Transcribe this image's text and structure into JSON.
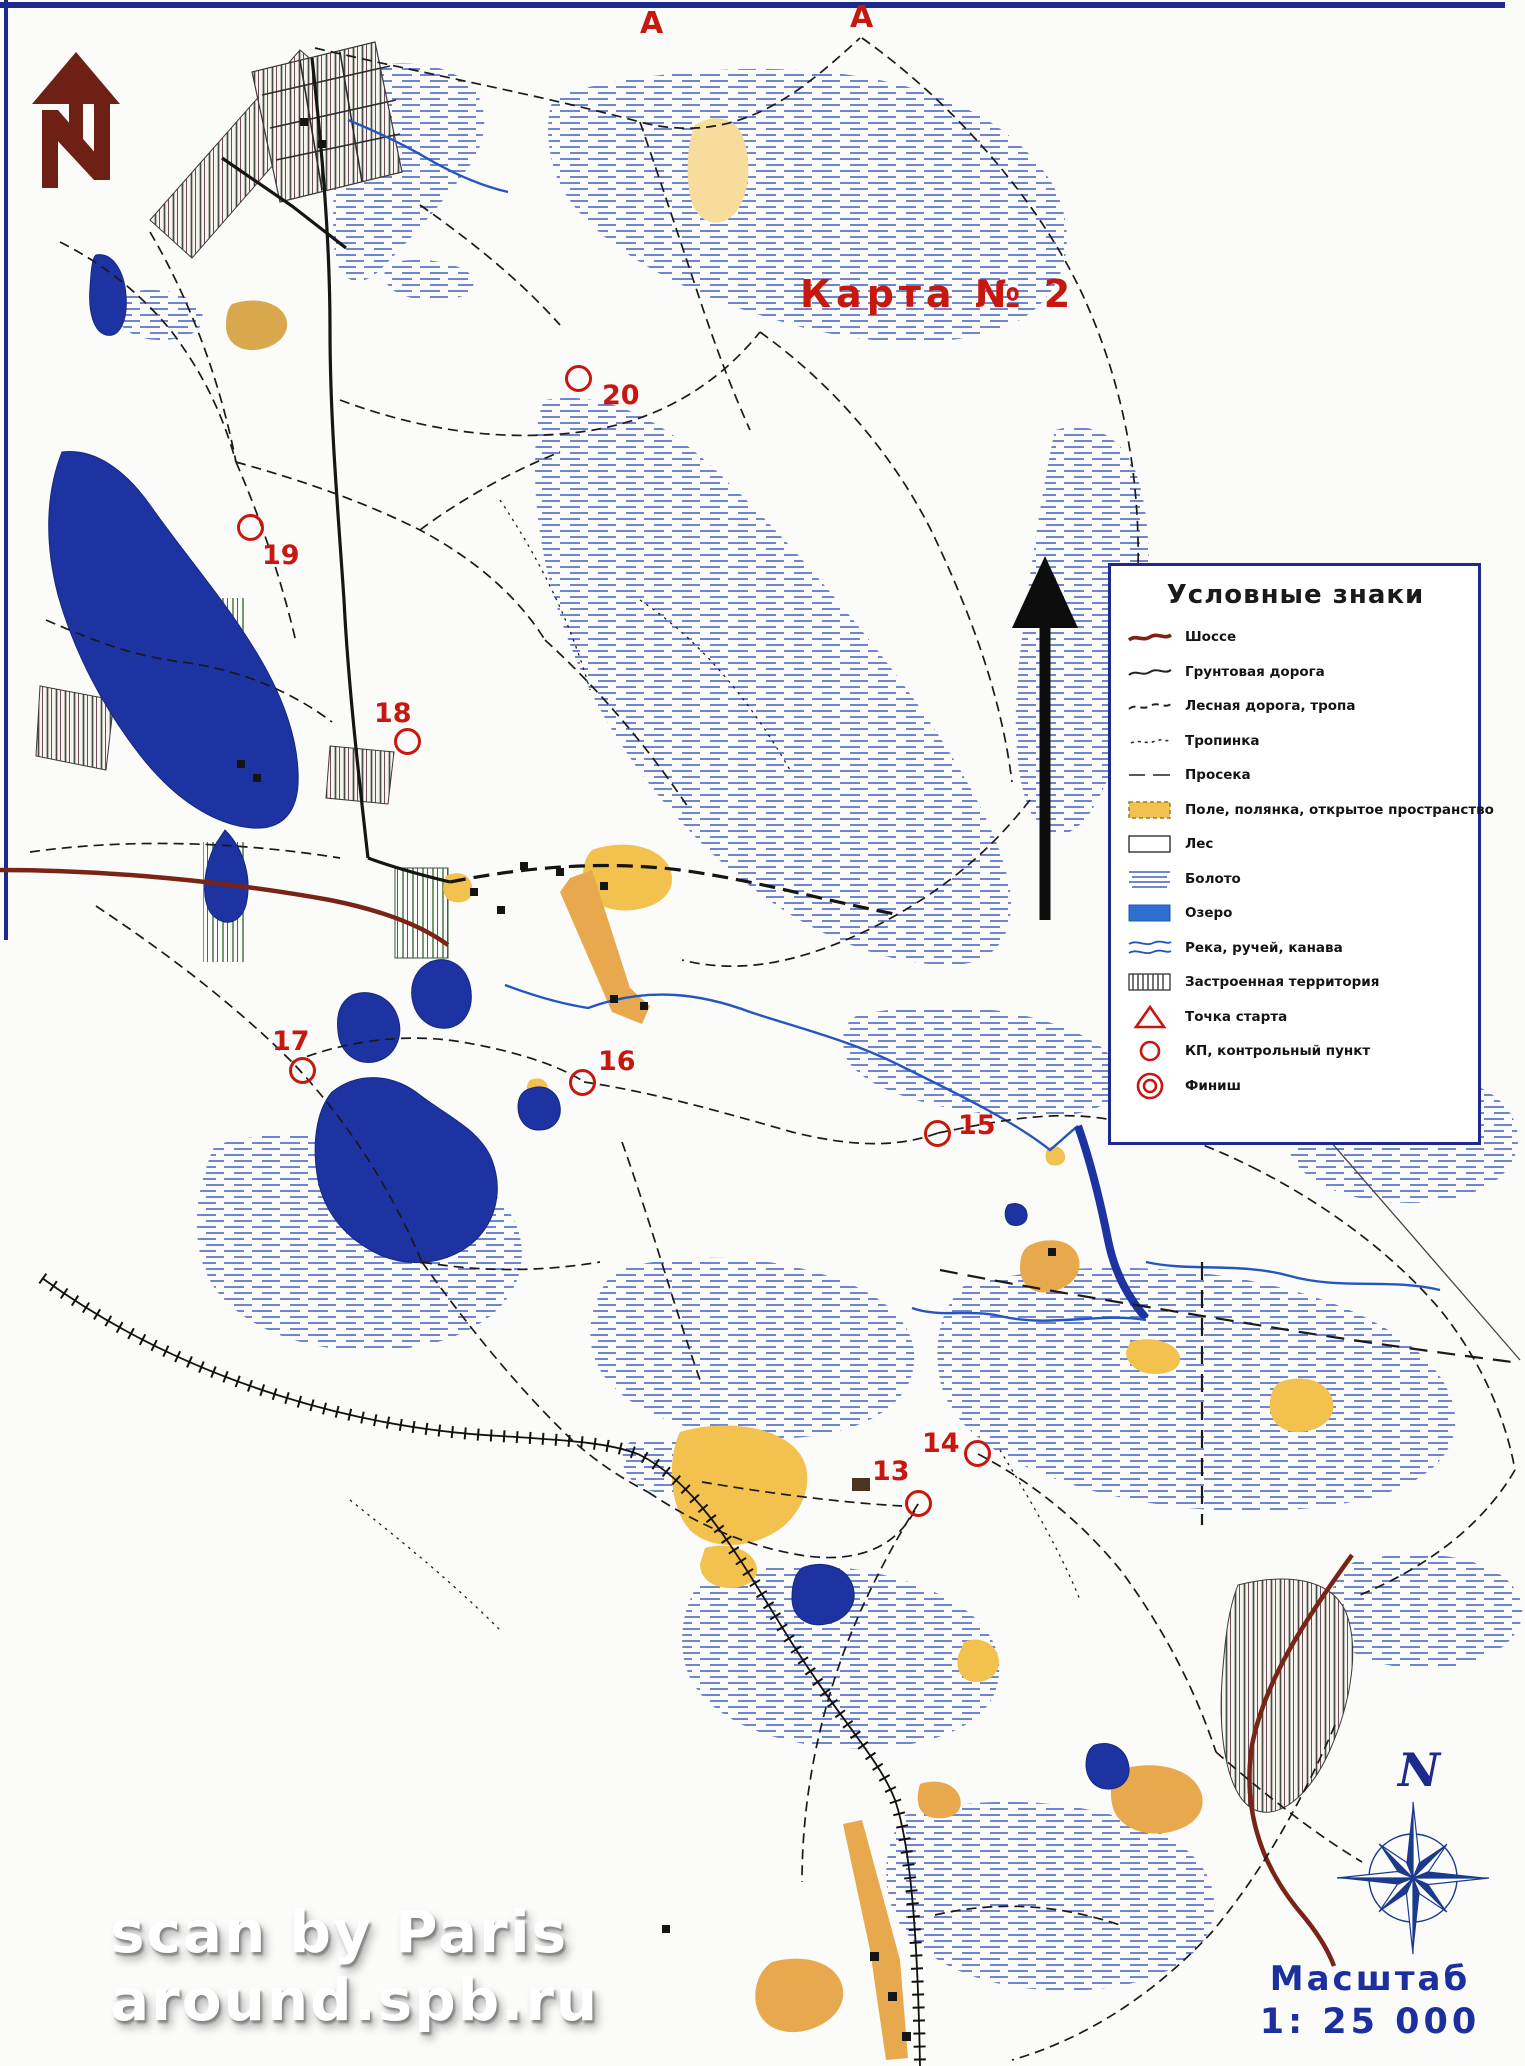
{
  "map": {
    "title": "Карта № 2",
    "corridor_labels": [
      {
        "text": "А",
        "x": 640,
        "y": 6
      },
      {
        "text": "А",
        "x": 850,
        "y": 0
      }
    ],
    "control_points": [
      {
        "number": "13",
        "cx": 918,
        "cy": 1503,
        "lx": 872,
        "ly": 1458
      },
      {
        "number": "14",
        "cx": 977,
        "cy": 1453,
        "lx": 922,
        "ly": 1430
      },
      {
        "number": "15",
        "cx": 937,
        "cy": 1133,
        "lx": 958,
        "ly": 1112
      },
      {
        "number": "16",
        "cx": 582,
        "cy": 1082,
        "lx": 598,
        "ly": 1048
      },
      {
        "number": "17",
        "cx": 302,
        "cy": 1070,
        "lx": 272,
        "ly": 1028
      },
      {
        "number": "18",
        "cx": 407,
        "cy": 741,
        "lx": 374,
        "ly": 700
      },
      {
        "number": "19",
        "cx": 250,
        "cy": 527,
        "lx": 262,
        "ly": 542
      },
      {
        "number": "20",
        "cx": 578,
        "cy": 378,
        "lx": 602,
        "ly": 382
      }
    ]
  },
  "legend": {
    "title": "Условные знаки",
    "items": [
      {
        "symbol": "highway",
        "label": "Шоссе"
      },
      {
        "symbol": "dirt-road",
        "label": "Грунтовая дорога"
      },
      {
        "symbol": "forest-road",
        "label": "Лесная дорога, тропа"
      },
      {
        "symbol": "footpath",
        "label": "Тропинка"
      },
      {
        "symbol": "cutting",
        "label": "Просека"
      },
      {
        "symbol": "field",
        "label": "Поле, полянка, открытое пространство"
      },
      {
        "symbol": "forest",
        "label": "Лес"
      },
      {
        "symbol": "swamp",
        "label": "Болото"
      },
      {
        "symbol": "lake",
        "label": "Озеро"
      },
      {
        "symbol": "river",
        "label": "Река, ручей, канава"
      },
      {
        "symbol": "built-up",
        "label": "Застроенная территория"
      },
      {
        "symbol": "start",
        "label": "Точка старта"
      },
      {
        "symbol": "control",
        "label": "КП, контрольный пункт"
      },
      {
        "symbol": "finish",
        "label": "Финиш"
      }
    ]
  },
  "compass": {
    "north_label": "N"
  },
  "scale": {
    "label": "Масштаб",
    "value": "1: 25 000"
  },
  "watermark": {
    "line1": "scan by Paris",
    "line2": "around.spb.ru"
  },
  "colors": {
    "accent_red": "#c8170f",
    "lake_navy": "#1d33a2",
    "swamp_blue": "#5b74c8",
    "river_blue": "#2456c0",
    "field_yellow": "#f2c14e",
    "field_pale": "#f7dc9b",
    "field_orange": "#e8a94e",
    "highway_maroon": "#7a2418",
    "frame_blue": "#1b2a8c",
    "scale_blue": "#1c2f9e"
  }
}
